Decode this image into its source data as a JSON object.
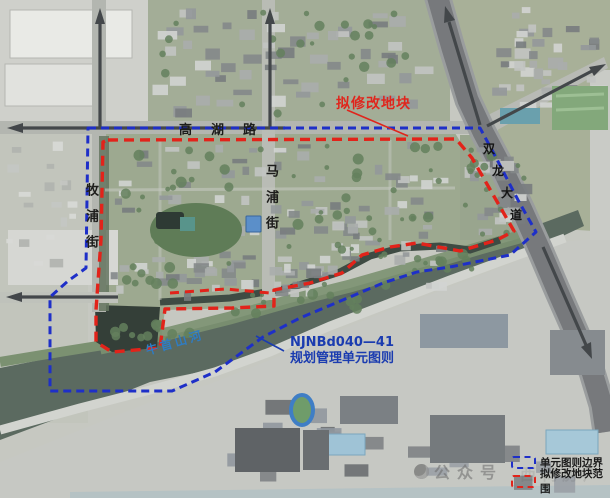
{
  "map_labels": {
    "road_top": "高湖路",
    "street_left": "牧浦街",
    "street_mid": "马浦街",
    "avenue": "双龙大道",
    "avenue_chars": [
      "双",
      "龙",
      "大",
      "道"
    ],
    "river": "牛首山河",
    "callout_red": "拟修改地块",
    "callout_blue_line1": "NJNBd040—41",
    "callout_blue_line2": "规划管理单元图则"
  },
  "legend": {
    "items": [
      {
        "id": "unit-boundary",
        "label": "单元图则边界",
        "color": "#1e2fc8"
      },
      {
        "id": "modify-scope",
        "label": "拟修改地块范围",
        "color": "#e2231a"
      }
    ]
  },
  "watermark": {
    "prefix": "公众号",
    "suffix": "西祠房产"
  },
  "colors": {
    "unit_boundary": "#1e2fc8",
    "modify_scope": "#e2231a",
    "river_label": "#2f7cc2",
    "callout_blue": "#1b3cb0",
    "callout_red": "#e0251c"
  }
}
